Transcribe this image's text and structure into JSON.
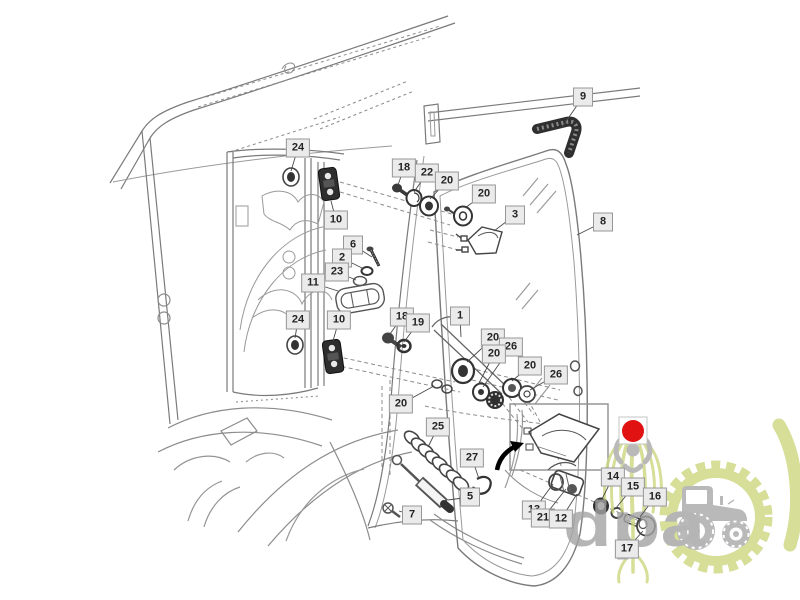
{
  "watermark": {
    "text": "dpa",
    "brand_green": "#ccd67f",
    "brand_gray": "#a8a8a8"
  },
  "marker": {
    "shape": "red-dot",
    "x": 633,
    "y": 431,
    "radius": 11,
    "color": "#e11212"
  },
  "callouts": [
    {
      "num": "24",
      "x": 298,
      "y": 148,
      "tx": 291,
      "ty": 171
    },
    {
      "num": "10",
      "x": 336,
      "y": 220,
      "tx": 331,
      "ty": 201
    },
    {
      "num": "6",
      "x": 353,
      "y": 245,
      "tx": 372,
      "ty": 257
    },
    {
      "num": "2",
      "x": 342,
      "y": 258,
      "tx": 364,
      "ty": 269
    },
    {
      "num": "23",
      "x": 337,
      "y": 272,
      "tx": 356,
      "ty": 280
    },
    {
      "num": "11",
      "x": 313,
      "y": 283,
      "tx": 338,
      "ty": 291
    },
    {
      "num": "24",
      "x": 298,
      "y": 320,
      "tx": 295,
      "ty": 338
    },
    {
      "num": "10",
      "x": 339,
      "y": 320,
      "tx": 333,
      "ty": 341
    },
    {
      "num": "18",
      "x": 402,
      "y": 317,
      "tx": 390,
      "ty": 334
    },
    {
      "num": "19",
      "x": 418,
      "y": 323,
      "tx": 404,
      "ty": 342
    },
    {
      "num": "9",
      "x": 583,
      "y": 97,
      "tx": 562,
      "ty": 127
    },
    {
      "num": "8",
      "x": 603,
      "y": 222,
      "tx": 577,
      "ty": 235
    },
    {
      "num": "18",
      "x": 404,
      "y": 168,
      "tx": 398,
      "ty": 185
    },
    {
      "num": "22",
      "x": 427,
      "y": 173,
      "tx": 414,
      "ty": 192
    },
    {
      "num": "20",
      "x": 447,
      "y": 181,
      "tx": 430,
      "ty": 199
    },
    {
      "num": "20",
      "x": 484,
      "y": 194,
      "tx": 465,
      "ty": 208
    },
    {
      "num": "3",
      "x": 515,
      "y": 215,
      "tx": 494,
      "ty": 231
    },
    {
      "num": "1",
      "x": 460,
      "y": 316,
      "tx": 461,
      "ty": 337
    },
    {
      "num": "20",
      "x": 493,
      "y": 338,
      "tx": 467,
      "ty": 362
    },
    {
      "num": "26",
      "x": 511,
      "y": 347,
      "tx": 483,
      "ty": 387
    },
    {
      "num": "20",
      "x": 494,
      "y": 354,
      "tx": 478,
      "ty": 385
    },
    {
      "num": "20",
      "x": 530,
      "y": 366,
      "tx": 512,
      "ty": 381
    },
    {
      "num": "26",
      "x": 556,
      "y": 375,
      "tx": 530,
      "ty": 390
    },
    {
      "num": "20",
      "x": 401,
      "y": 404,
      "tx": 434,
      "ty": 386
    },
    {
      "num": "25",
      "x": 438,
      "y": 427,
      "tx": 428,
      "ty": 447
    },
    {
      "num": "27",
      "x": 472,
      "y": 458,
      "tx": 479,
      "ty": 479
    },
    {
      "num": "5",
      "x": 470,
      "y": 497,
      "tx": 448,
      "ty": 500
    },
    {
      "num": "7",
      "x": 412,
      "y": 515,
      "tx": 399,
      "ty": 511
    },
    {
      "num": "13",
      "x": 534,
      "y": 510,
      "tx": 553,
      "ty": 484
    },
    {
      "num": "21",
      "x": 543,
      "y": 518,
      "tx": 566,
      "ty": 489
    },
    {
      "num": "12",
      "x": 561,
      "y": 519,
      "tx": 577,
      "ty": 494
    },
    {
      "num": "14",
      "x": 613,
      "y": 477,
      "tx": 602,
      "ty": 499
    },
    {
      "num": "15",
      "x": 633,
      "y": 487,
      "tx": 616,
      "ty": 508
    },
    {
      "num": "16",
      "x": 655,
      "y": 497,
      "tx": 640,
      "ty": 517
    },
    {
      "num": "17",
      "x": 627,
      "y": 549,
      "tx": 643,
      "ty": 531
    }
  ]
}
